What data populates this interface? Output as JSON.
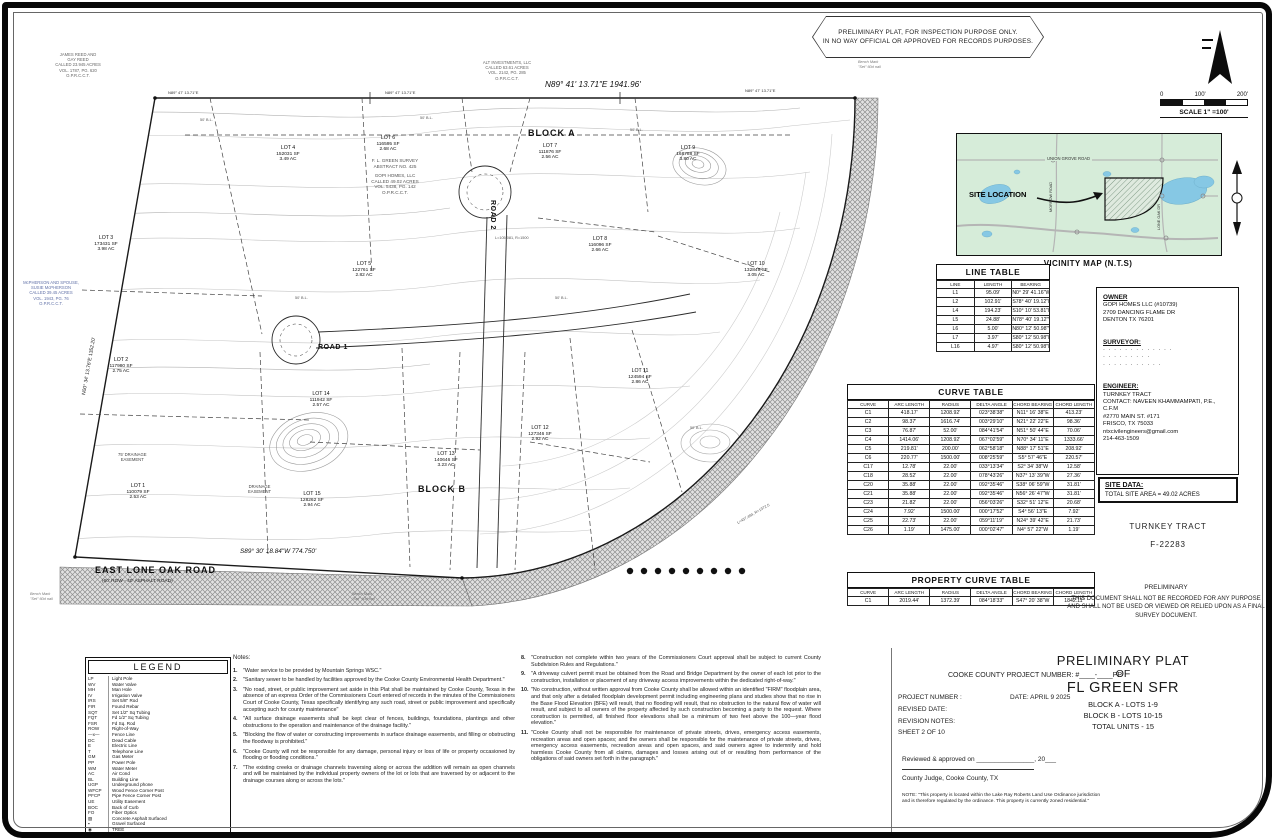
{
  "banner": {
    "line1": "PRELIMINARY PLAT, FOR INSPECTION PURPOSE ONLY.",
    "line2": "IN NO WAY OFFICIAL OR APPROVED FOR RECORDS PURPOSES."
  },
  "scale": {
    "ticks": [
      "0",
      "100'",
      "200'"
    ],
    "label": "SCALE 1\" =100'"
  },
  "vicinity": {
    "title": "VICINITY MAP (N.T.S)",
    "site_location": "SITE LOCATION",
    "union_grove": "UNION GROVE ROAD",
    "morrow": "MORROW ROAD",
    "lone_oak": "LONE OAK DR"
  },
  "line_table": {
    "title": "LINE TABLE",
    "headers": [
      "LINE",
      "LENGTH",
      "BEARING"
    ],
    "rows": [
      [
        "L1",
        "95.09'",
        "N0° 29' 41.16\"W"
      ],
      [
        "L2",
        "102.91'",
        "S78° 40' 19.12\"E"
      ],
      [
        "L4",
        "194.23'",
        "S10° 10' 53.81\"E"
      ],
      [
        "L5",
        "24.88'",
        "N78° 40' 19.12\"W"
      ],
      [
        "L6",
        "5.00'",
        "N80° 12' 50.98\"W"
      ],
      [
        "L7",
        "3.97'",
        "S80° 12' 50.98\"E"
      ],
      [
        "L16",
        "4.97'",
        "S80° 12' 50.98\"E"
      ]
    ]
  },
  "curve_table": {
    "title": "CURVE TABLE",
    "headers": [
      "CURVE",
      "ARC LENGTH",
      "RADIUS",
      "DELTA ANGLE",
      "CHORD BEARING",
      "CHORD LENGTH"
    ],
    "rows": [
      [
        "C1",
        "418.17'",
        "1208.92'",
        "023°38'38\"",
        "N11° 16' 38\"E",
        "413.23'"
      ],
      [
        "C2",
        "98.37'",
        "1616.74'",
        "003°29'10\"",
        "N21° 22' 22\"E",
        "98.36'"
      ],
      [
        "C3",
        "76.87'",
        "52.00'",
        "084°41'54\"",
        "N51° 50' 44\"E",
        "70.06'"
      ],
      [
        "C4",
        "1414.06'",
        "1208.92'",
        "067°02'59\"",
        "N70° 34' 11\"E",
        "1333.66'"
      ],
      [
        "C5",
        "219.81'",
        "200.00'",
        "062°58'18\"",
        "N88° 17' 51\"E",
        "208.92'"
      ],
      [
        "C6",
        "220.77'",
        "1500.00'",
        "008°25'59\"",
        "S5° 57' 46\"E",
        "220.57'"
      ],
      [
        "C17",
        "12.78'",
        "22.00'",
        "033°13'34\"",
        "S2° 34' 38\"W",
        "12.58'"
      ],
      [
        "C18",
        "28.52'",
        "22.00'",
        "078°43'26\"",
        "N37° 13' 39\"W",
        "27.36'"
      ],
      [
        "C20",
        "35.88'",
        "22.00'",
        "092°35'46\"",
        "S38° 06' 59\"W",
        "31.81'"
      ],
      [
        "C21",
        "35.88'",
        "22.00'",
        "092°35'46\"",
        "N56° 26' 47\"W",
        "31.81'"
      ],
      [
        "C23",
        "21.82'",
        "22.00'",
        "056°03'26\"",
        "S32° 51' 12\"E",
        "20.68'"
      ],
      [
        "C24",
        "7.92'",
        "1500.00'",
        "000°17'52\"",
        "S4° 56' 13\"E",
        "7.92'"
      ],
      [
        "C25",
        "22.73'",
        "22.00'",
        "059°11'19\"",
        "N24° 39' 42\"E",
        "21.73'"
      ],
      [
        "C26",
        "1.19'",
        "1475.00'",
        "000°02'47\"",
        "N4° 57' 22\"W",
        "1.19'"
      ]
    ]
  },
  "property_curve_table": {
    "title": "PROPERTY CURVE TABLE",
    "headers": [
      "CURVE",
      "ARC LENGTH",
      "RADIUS",
      "DELTA ANGLE",
      "CHORD BEARING",
      "CHORD LENGTH"
    ],
    "rows": [
      [
        "C1",
        "2019.44'",
        "1372.39'",
        "084°18'33\"",
        "S47° 20' 38\"W",
        "1842.11'"
      ]
    ]
  },
  "owner_box": {
    "owner_heading": "OWNER",
    "owner_lines": [
      "GOPI HOMES LLC (#10739)",
      "2709 DANCING FLAME DR",
      "DENTON TX 76201"
    ],
    "surveyor_heading": "SURVEYOR:",
    "surveyor_lines": [
      "· · · · · · · · · · · · ·",
      "· · · · · · · · ·",
      "· · · · · · · · · · ·"
    ],
    "engineer_heading": "ENGINEER:",
    "engineer_lines": [
      "TURNKEY TRACT",
      "CONTACT: NAVEEN KHAMMAMPATI, P.E., C.F.M",
      "#2770 MAIN ST. #171",
      "FRISCO, TX 75033",
      "ntxcivilengineers@gmail.com",
      "214-463-1509"
    ]
  },
  "site_data": {
    "heading": "SITE DATA:",
    "area_line": "TOTAL SITE AREA = 49.02 ACRES",
    "firm_name": "TURNKEY TRACT",
    "firm_number": "F-22283"
  },
  "preliminary_note": {
    "title": "PRELIMINARY",
    "body": "THIS DOCUMENT SHALL NOT BE RECORDED FOR ANY PURPOSE AND SHALL NOT BE USED OR VIEWED OR RELIED UPON AS A FINAL SURVEY DOCUMENT."
  },
  "legend": {
    "title": "LEGEND",
    "items": [
      {
        "sym": "LP",
        "label": "Light Pole"
      },
      {
        "sym": "WV",
        "label": "Water Valve"
      },
      {
        "sym": "MH",
        "label": "Man Hole"
      },
      {
        "sym": "IV",
        "label": "Irrigation Valve"
      },
      {
        "sym": "IRS",
        "label": "Set 5/8\" Rod"
      },
      {
        "sym": "FIR",
        "label": "Found Rebar"
      },
      {
        "sym": "SQT",
        "label": "Set 1/2\" Sq Tubing"
      },
      {
        "sym": "FQT",
        "label": "Fd 1/2\" Sq Tubing"
      },
      {
        "sym": "FSR",
        "label": "Fd Sq. Rod"
      },
      {
        "sym": "ROW",
        "label": "Right-of-Way"
      },
      {
        "sym": "—x—",
        "label": "Fence Line"
      },
      {
        "sym": "DC",
        "label": "Dead Cable"
      },
      {
        "sym": "E",
        "label": "Electric Line"
      },
      {
        "sym": "T",
        "label": "Telephone Line"
      },
      {
        "sym": "GM",
        "label": "Gas Meter"
      },
      {
        "sym": "PP",
        "label": "Power Pole"
      },
      {
        "sym": "WM",
        "label": "Water Meter"
      },
      {
        "sym": "AC",
        "label": "Air Cond"
      },
      {
        "sym": "BL",
        "label": "Building Line"
      },
      {
        "sym": "UGP",
        "label": "Underground phone"
      },
      {
        "sym": "WFCP",
        "label": "Wood Fence Corner Post"
      },
      {
        "sym": "PFCP",
        "label": "Pipe Fence Corner Post"
      },
      {
        "sym": "UE",
        "label": "Utility Easement"
      },
      {
        "sym": "BOC",
        "label": "Back of Curb"
      },
      {
        "sym": "FO",
        "label": "Fiber Optics"
      },
      {
        "sym": "▨",
        "label": "Concrete Asphalt Surfaced"
      },
      {
        "sym": "▪",
        "label": "Gravel Surfaced"
      },
      {
        "sym": "◉",
        "label": "TREE"
      },
      {
        "sym": "— —",
        "label": "Edge of Road"
      }
    ]
  },
  "notes": {
    "heading": "Notes:",
    "col1": [
      {
        "num": "1.",
        "text": "\"Water service to be provided by Mountain Springs WSC.\""
      },
      {
        "num": "2.",
        "text": "\"Sanitary sewer to be handled by facilities approved by the Cooke County Environmental Health Department.\""
      },
      {
        "num": "3.",
        "text": "\"No road, street, or public improvement set aside in this Plat shall be maintained by Cooke County, Texas in the absence of an express Order of the Commissioners Court entered of records in the minutes of the Commissioners Court of Cooke County, Texas specifically identifying any such road, street or public improvement and specifically accepting such for county maintenance\""
      },
      {
        "num": "4.",
        "text": "\"All surface drainage easements shall be kept clear of fences, buildings, foundations, plantings and other obstructions to the operation and maintenance of the drainage facility.\""
      },
      {
        "num": "5.",
        "text": "\"Blocking the flow of water or constructing improvements in surface drainage easements, and filling or obstructing the floodway is prohibited.\""
      },
      {
        "num": "6.",
        "text": "\"Cooke County will not be responsible for any damage, personal injury or loss of life or property occasioned by flooding or flooding conditions.\""
      },
      {
        "num": "7.",
        "text": "\"The existing creeks or drainage channels traversing along or across the addition will remain as open channels and will be maintained by the individual property owners of the lot or lots that are traversed by or adjacent to the drainage courses along or across the lots.\""
      }
    ],
    "col2": [
      {
        "num": "8.",
        "text": "\"Construction not complete within two years of the Commissioners Court approval shall be subject to current County Subdivision Rules and Regulations.\""
      },
      {
        "num": "9.",
        "text": "\"A driveway culvert permit must be obtained from the Road and Bridge Department by the owner of each lot prior to the construction, installation or placement of any driveway access improvements within the dedicated right-of-way.\""
      },
      {
        "num": "10.",
        "text": "\"No construction, without written approval from Cooke County shall be allowed within an identified \"FIRM\" floodplain area, and that only after a detailed floodplain development permit including engineering plans and studies show that no rise in the Base Flood Elevation (BFE) will result, that no flooding will result, that no obstruction to the natural flow of water will result, and subject to all owners of the property affected by such construction becoming a party to the request. Where construction is permitted, all finished floor elevations shall be a minimum of two feet above the 100—year flood elevation.\""
      },
      {
        "num": "11.",
        "text": "\"Cooke County shall not be responsible for maintenance of private streets, drives, emergency access easements, recreation areas and open spaces; and the owners shall be responsible for the maintenance of private streets, drives, emergency access easements, recreation areas and open spaces, and said owners agree to indemnify and hold harmless Cooke County from all claims, damages and losses arising out of or resulting from performance of the obligations of said owners set forth in the paragraph.\""
      }
    ]
  },
  "title_block": {
    "county_project_line": "COOKE COUNTY PROJECT NUMBER:  #____-____PP",
    "project_number_label": "PROJECT NUMBER :",
    "date_line": "DATE:  APRIL 9 2025",
    "revised_date_label": "REVISED DATE:",
    "revision_notes_label": "REVISION NOTES:",
    "sheet_label": "SHEET 2 OF 10",
    "reviewed_line": "Reviewed & approved on ________________, 20___",
    "judge_line": "County Judge, Cooke County, TX",
    "ordinance_note": "NOTE: \"This property is located within the Lake Ray Roberts Land Use Ordinance jurisdiction and is therefore regulated by the ordinance. This property is currently zoned residential.\"",
    "title_line1": "PRELIMINARY PLAT",
    "title_line2": "OF",
    "title_line3": "FL GREEN SFR",
    "block_a_line": "BLOCK A - LOTS 1-9",
    "block_b_line": "BLOCK B - LOTS 10-15",
    "total_units_line": "TOTAL UNITS - 15"
  },
  "plat": {
    "block_a": "BLOCK A",
    "block_b": "BLOCK B",
    "road_1": "ROAD 1",
    "road_2": "ROAD 2",
    "east_lone_oak_road": "EAST LONE OAK ROAD",
    "east_lone_oak_sub": "(60' ROW - 40' ASPHALT ROAD)",
    "bearing_top_main": "N89° 41' 13.71\"E  1941.96'",
    "bearing_top_seg": "N89° 47' 13.71\"E",
    "bearing_bottom": "S89° 30' 18.84\"W  774.750'",
    "bearing_left": "N00° 34' 13.76\"E  1352.20'",
    "bl_label": "50' B.L.",
    "drainage_75a": "75' DRAINAGE",
    "drainage_75b": "EASEMENT",
    "drainage_a": "DRAINAGE",
    "drainage_b": "EASEMENT",
    "bench_line1": "Bench Mark",
    "bench_line2": "\"Set\" 60d nail",
    "curve_callout_1": "L=105.081, R=1500",
    "curve_callout_2": "L=437.484, R=1372.5",
    "survey_block": [
      "F. L. GREEN SURVEY",
      "ABSTRACT NO. 425"
    ],
    "owner_called_block": [
      "GOPI HOMES, LLC",
      "CALLED 49.02 ACRES",
      "VOL. 5438, PG. 142",
      "O.P.R.C.C.T."
    ],
    "adjacent_owner_nw": [
      "JAMES REED AND",
      "GAY REED",
      "CALLED 23.945 ACRES",
      "VOL. 1787, PG. 620",
      "O.P.R.C.C.T."
    ],
    "adjacent_owner_w": [
      "McPHERSON AND SPOUSE,",
      "SUSIE McPHERSON",
      "CALLED 39.45 ACRES",
      "VOL. 1943, PG. 76",
      "O.P.R.C.C.T."
    ],
    "adjacent_owner_n": [
      "ALT INVESTMENTS, LLC",
      "CALLED 63.61 ACRES",
      "VOL. 2142, PG. 285",
      "O.P.R.C.C.T."
    ],
    "lots": [
      {
        "name": "LOT 1",
        "sf": "110079 SF",
        "ac": "2.53 AC"
      },
      {
        "name": "LOT 2",
        "sf": "117980 SF",
        "ac": "2.75 AC"
      },
      {
        "name": "LOT 3",
        "sf": "173431 SF",
        "ac": "3.98 AC"
      },
      {
        "name": "LOT 4",
        "sf": "152031 SF",
        "ac": "3.49 AC"
      },
      {
        "name": "LOT 5",
        "sf": "122761 SF",
        "ac": "2.82 AC"
      },
      {
        "name": "LOT 6",
        "sf": "116595 SF",
        "ac": "2.68 AC"
      },
      {
        "name": "LOT 7",
        "sf": "111876 SF",
        "ac": "2.56 AC"
      },
      {
        "name": "LOT 8",
        "sf": "116096 SF",
        "ac": "2.66 AC"
      },
      {
        "name": "LOT 9",
        "sf": "168788 SF",
        "ac": "3.80 AC"
      },
      {
        "name": "LOT 10",
        "sf": "132849 SF",
        "ac": "3.05 AC"
      },
      {
        "name": "LOT 11",
        "sf": "124594 SF",
        "ac": "2.86 AC"
      },
      {
        "name": "LOT 12",
        "sf": "127346 SF",
        "ac": "2.92 AC"
      },
      {
        "name": "LOT 13",
        "sf": "140646 SF",
        "ac": "3.23 AC"
      },
      {
        "name": "LOT 14",
        "sf": "111942 SF",
        "ac": "2.57 AC"
      },
      {
        "name": "LOT 15",
        "sf": "128262 SF",
        "ac": "2.94 AC"
      }
    ]
  }
}
